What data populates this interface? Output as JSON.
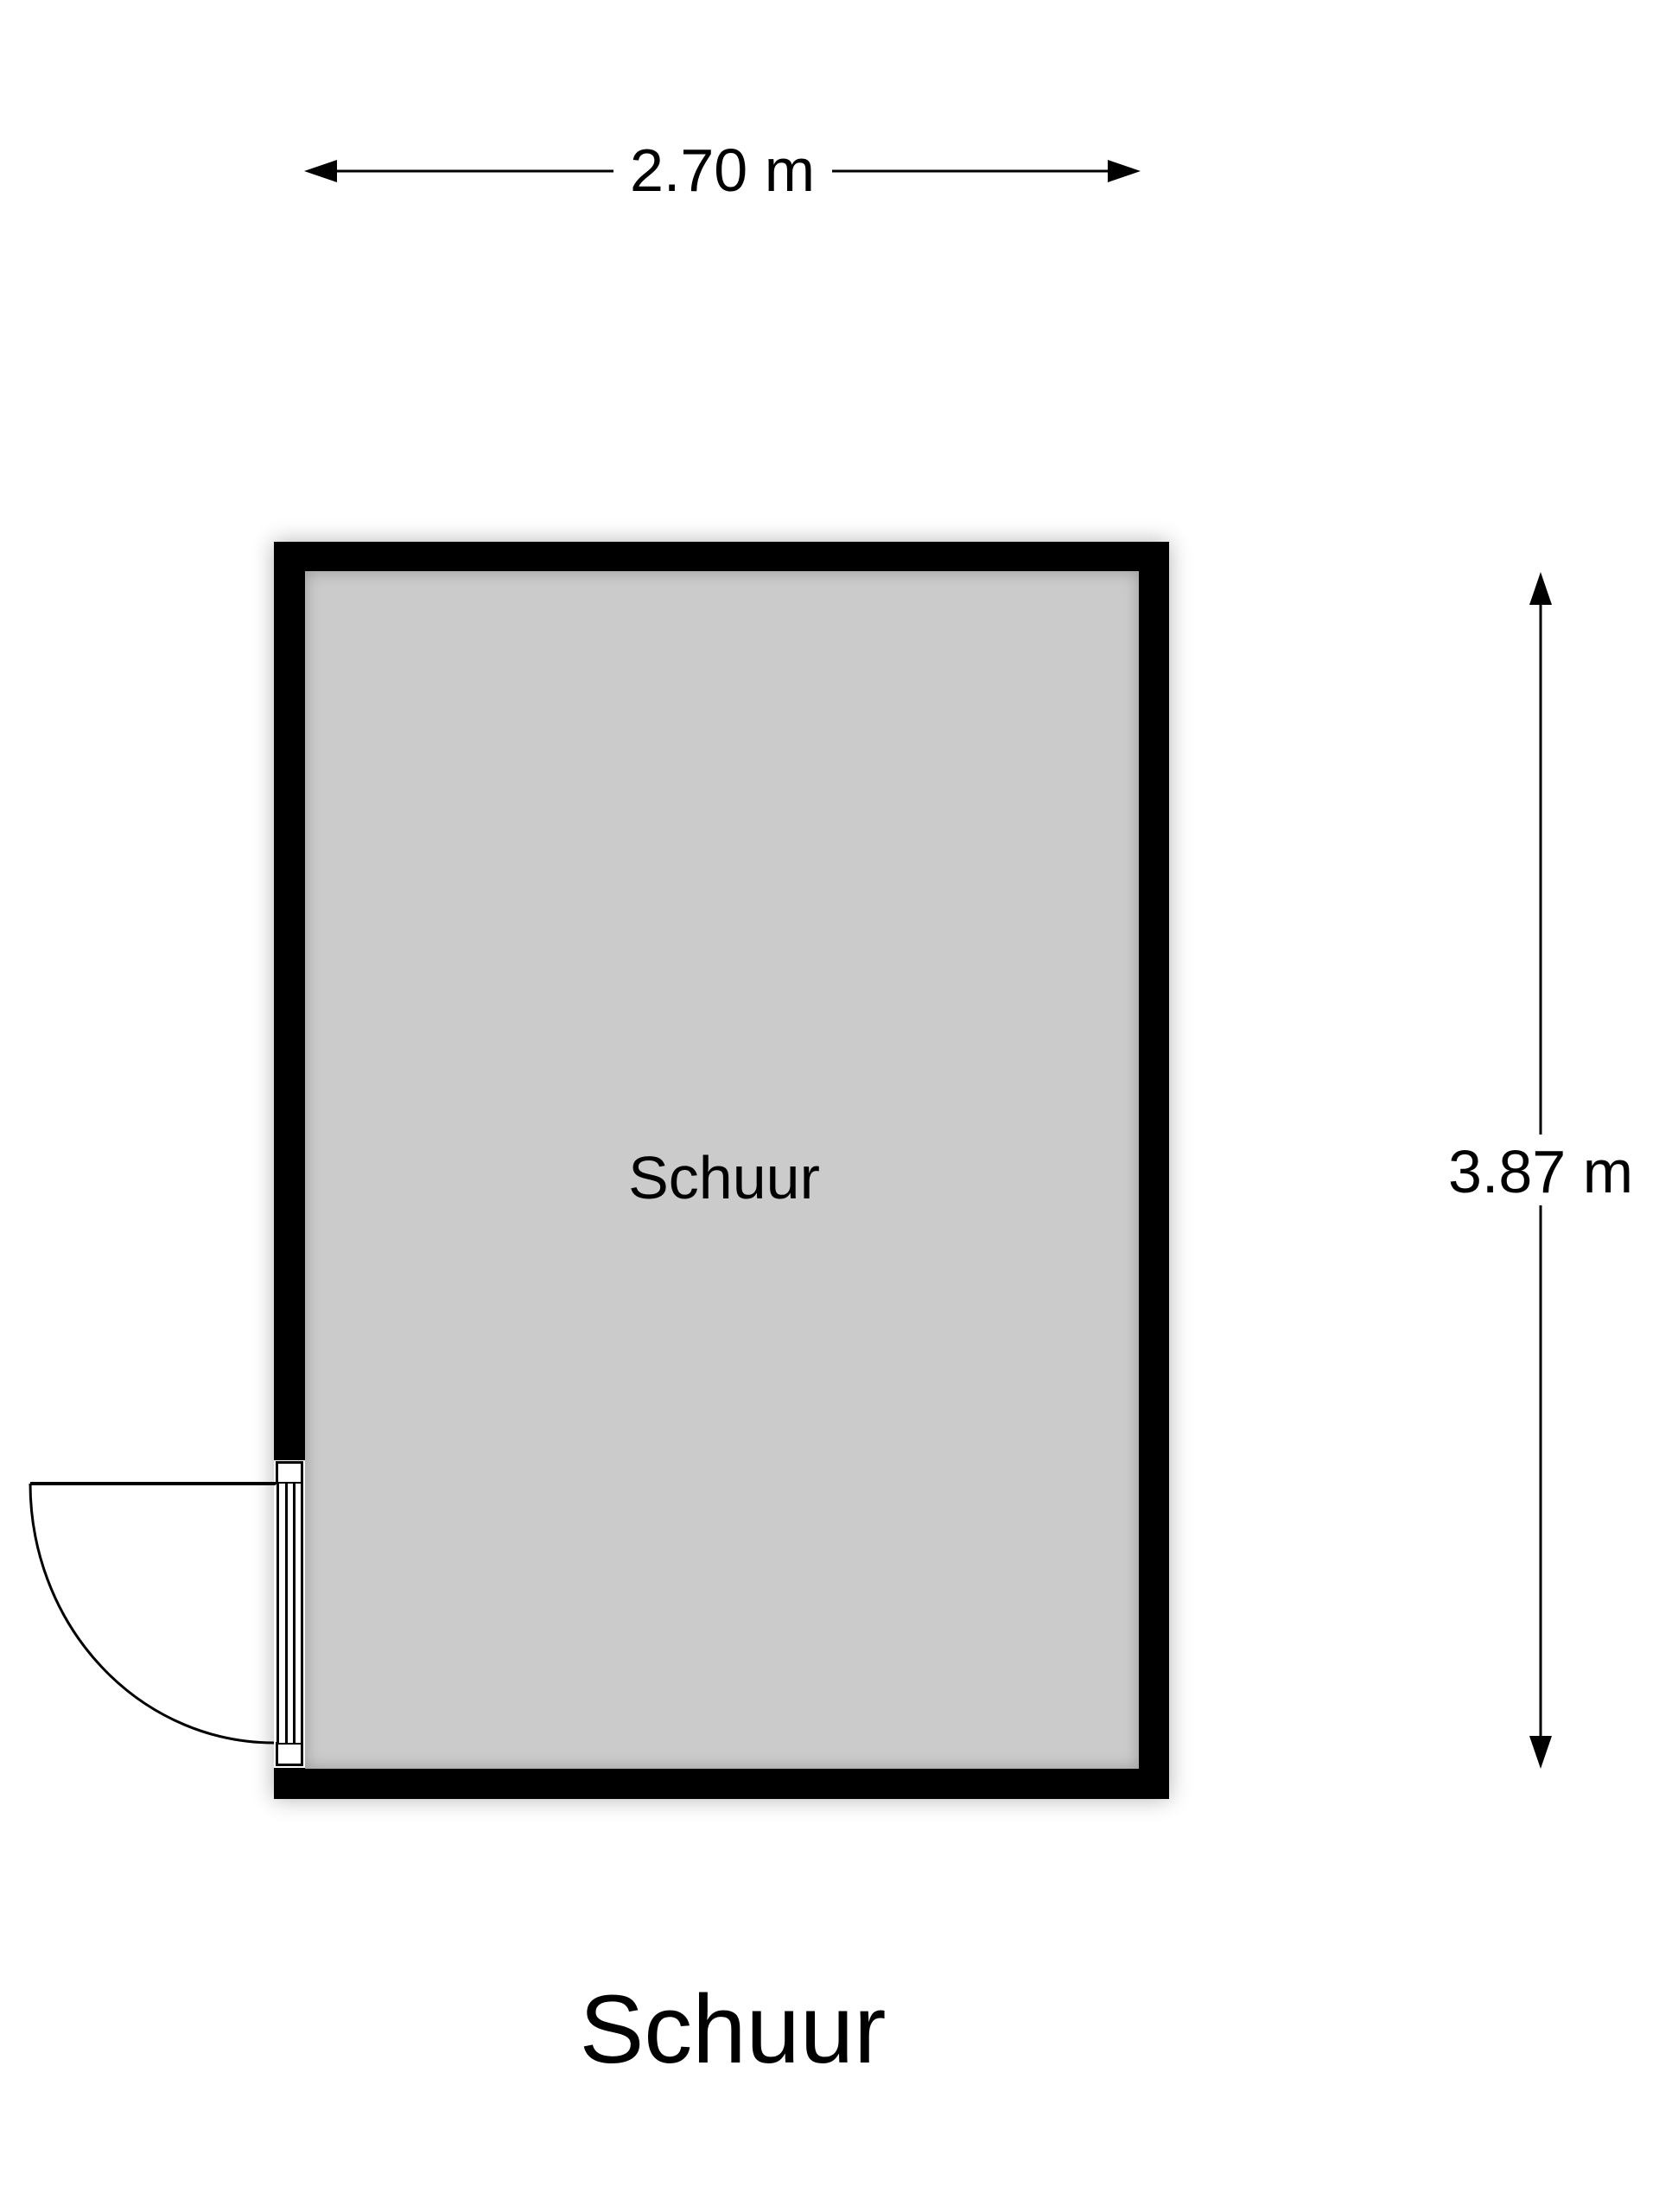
{
  "title": "Schuur",
  "room": {
    "label": "Schuur",
    "floor_type": "shed"
  },
  "dimensions": {
    "width_label": "2.70 m",
    "width_value": 2.7,
    "height_label": "3.87 m",
    "height_value": 3.87,
    "unit": "m"
  },
  "colors": {
    "wall": "#000000",
    "floor": "#cbcbcb",
    "stroke": "#000000",
    "page_bg": "#ffffff"
  }
}
